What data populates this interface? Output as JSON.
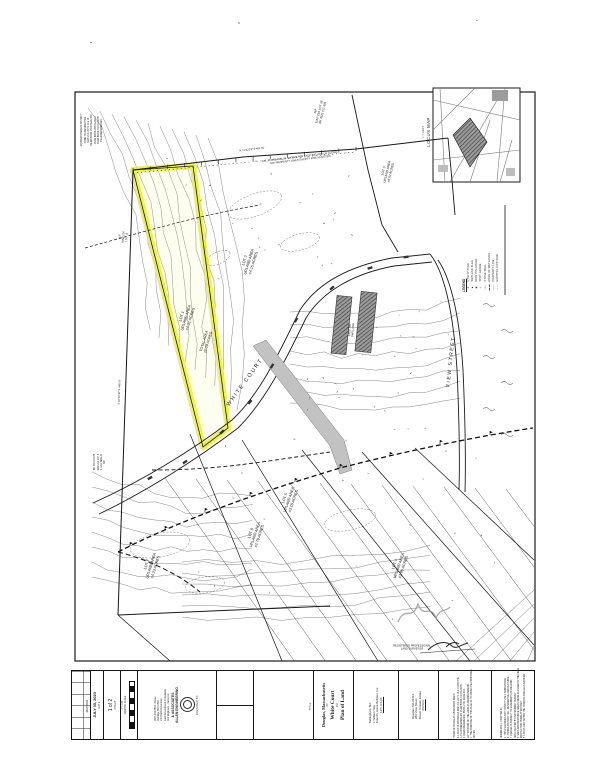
{
  "colors": {
    "ink": "#1c1c1c",
    "highlight": "#e7ee3c",
    "gray_fill": "#c2c2c2",
    "hatch_dark": "#3a3a3a"
  },
  "locus": {
    "label": "LOCUS MAP",
    "scale": "1\" = 1000'±"
  },
  "legend": {
    "title": "LEGEND",
    "items": [
      {
        "symbol": "dash",
        "label": "EXISTING CONTOUR"
      },
      {
        "symbol": "solid",
        "label": "PROPERTY LINE"
      },
      {
        "symbol": "boldash",
        "label": "EDGE OF WETLANDS"
      },
      {
        "symbol": "wall",
        "label": "STONE WALL"
      },
      {
        "symbol": "plus",
        "label": "SPOT GRADE"
      },
      {
        "symbol": "circle",
        "label": "IRON PIN FOUND"
      },
      {
        "symbol": "tri",
        "label": "WETLAND FLAG"
      },
      {
        "symbol": "ast",
        "label": "UTILITY POLE"
      }
    ]
  },
  "map": {
    "corner_notes": [
      "PLAN REFERENCES:",
      "PLAN BOOK 310  PLAN 55",
      "PLAN BOOK 298  PLAN 12",
      "DEED BOOK 1521  PAGE 204",
      "MAP 210  LOTS 12 & 14",
      "ZONE: RA  RESIDENTIAL",
      "AQUIFER OVERLAY DISTRICT"
    ],
    "abutter_note": [
      "N/F",
      "J. & M. WALLIS",
      "MAP 210 LOT 9",
      "BK 3301 PG 88"
    ],
    "labels": [
      {
        "x": 187,
        "y": 318,
        "r": -73,
        "s": 3.8,
        "lines": [
          "LOT 1",
          "UPLAND AREA",
          "±4.31 ACRES"
        ]
      },
      {
        "x": 207,
        "y": 342,
        "r": -73,
        "s": 3.6,
        "lines": [
          "TOTAL AREA",
          "±5.09 ACRES"
        ]
      },
      {
        "x": 250,
        "y": 262,
        "r": -73,
        "s": 3.8,
        "lines": [
          "LOT 2",
          "UPLAND AREA",
          "±4.15 ACRES"
        ]
      },
      {
        "x": 388,
        "y": 172,
        "r": -76,
        "s": 3.2,
        "lines": [
          "LOT 3",
          "UPLAND AREA",
          "±6.02 ACRES"
        ]
      },
      {
        "x": 320,
        "y": 112,
        "r": -76,
        "s": 3.0,
        "lines": [
          "N/F",
          "MAP 210 LOT 18",
          "BK 4521 PG 301"
        ]
      },
      {
        "x": 124,
        "y": 237,
        "r": -86,
        "s": 2.8,
        "lines": [
          "N/F",
          "MAP 210",
          "LOT 11"
        ]
      },
      {
        "x": 290,
        "y": 500,
        "r": -71,
        "s": 3.8,
        "lines": [
          "LOT 5",
          "UPLAND AREA",
          "±3.18 ACRES"
        ]
      },
      {
        "x": 256,
        "y": 535,
        "r": -71,
        "s": 3.8,
        "lines": [
          "LOT 6",
          "UPLAND AREA",
          "±2.79 ACRES"
        ]
      },
      {
        "x": 152,
        "y": 566,
        "r": -73,
        "s": 3.8,
        "lines": [
          "LOT 7",
          "UPLAND AREA",
          "±4.23 ACRES"
        ]
      },
      {
        "x": 400,
        "y": 566,
        "r": -71,
        "s": 3.8,
        "lines": [
          "LOT 4",
          "UPLAND AREA",
          "±3.96 ACRES"
        ]
      },
      {
        "x": 246,
        "y": 383,
        "r": -54,
        "s": 5.4,
        "ls": 1.8,
        "lines": [
          "WHITE COURT"
        ]
      },
      {
        "x": 452,
        "y": 362,
        "r": -84,
        "s": 5.0,
        "ls": 1.6,
        "lines": [
          "VIEW STREET"
        ]
      },
      {
        "x": 300,
        "y": 159,
        "r": -7,
        "s": 2.7,
        "lines": [
          "ALL STONE WALLS SHOWN ARE EXISTING AND LIE ALONG",
          "THE PROPERTY LINES EXCEPT FOR AS NOTED"
        ]
      },
      {
        "x": 252,
        "y": 150,
        "r": -7,
        "s": 2.6,
        "lines": [
          "N 71°42'18\" E   402.55'"
        ]
      },
      {
        "x": 120,
        "y": 392,
        "r": -88,
        "s": 2.6,
        "lines": [
          "S 18°22'40\" E   448.75'"
        ]
      },
      {
        "x": 352,
        "y": 330,
        "r": -86,
        "s": 2.7,
        "lines": [
          "EXISTING",
          "DWELLING"
        ]
      },
      {
        "x": 412,
        "y": 648,
        "r": 0,
        "s": 2.6,
        "lines": [
          "REGISTERED PROFESSIONAL",
          "LAND SURVEYOR"
        ]
      }
    ]
  },
  "titleblock": {
    "prepared_by_label": "PREPARED BY:",
    "firm_name_1": "ALLEN ENGINEERING",
    "firm_name_2": "& ASSOCIATES",
    "firm_lines": [
      "Civil Engineers - Surveyors",
      "Land Development Consultants",
      "141 Hartford Ave East",
      "Uxbridge, MA 01569",
      "(508) 234-6834 - Phone"
    ],
    "title_label": "TITLE:",
    "title_lines": [
      "Plan of Land",
      "For",
      "White Court",
      "IN",
      "Douglas, Massachusetts"
    ],
    "applicant_label": "APPLICANT:",
    "applicant_lines": [
      "Country Home Builders, Inc.",
      "1 William Way",
      "Bellingham, MA."
    ],
    "owner_label": "OWNER:",
    "owner_lines": [
      "Mount Tomash Estate",
      "280 View Street",
      "Douglas, MA 01516"
    ],
    "notes_col1": [
      "NOTES:",
      "1. THE PURPOSE OF THIS PLAN IS TO SHOW THE PROPOSED",
      "    LOT DIVISION OF THE LAND AS DRAWN HEREON.",
      "2. DEED REFERENCE: BOOK 1521 PAGE 204.",
      "3. PLAN REFERENCES: PLAN BOOK 310 PLAN 55.",
      "4. LOCUS IS SHOWN AS MAP 210 LOTS 12 & 14 ON THE",
      "    TOWN OF DOUGLAS ASSESSORS MAPS."
    ],
    "notes_col2": [
      "5. LOCUS LIES WITHIN THE TOWN OF DOUGLAS AQUIFER",
      "    PROTECTION OVERLAY DISTRICT.",
      "6. WETLAND RESOURCE AREAS WERE FLAGGED IN THE FIELD",
      "    AND LOCATED BY INSTRUMENT SURVEY.",
      "7. PARCEL IS SUBJECT TO EASEMENTS OF RECORD.",
      "8. ZONING DISTRICT: RA - RESIDENTIAL AGRICULTURAL.",
      "9. THIS PLAN DOES NOT CONSTITUTE A SUBDIVISION",
      "    UNDER M.G.L. CHAPTER 41."
    ],
    "date_label": "DATE",
    "date": "JULY 05, 2023",
    "sheet_label": "SHEET",
    "sheet": "1 of 2",
    "revisions_label": "REVISIONS",
    "scale_label": "GRAPHIC SCALE",
    "scale_value": "1\" = 100'"
  }
}
